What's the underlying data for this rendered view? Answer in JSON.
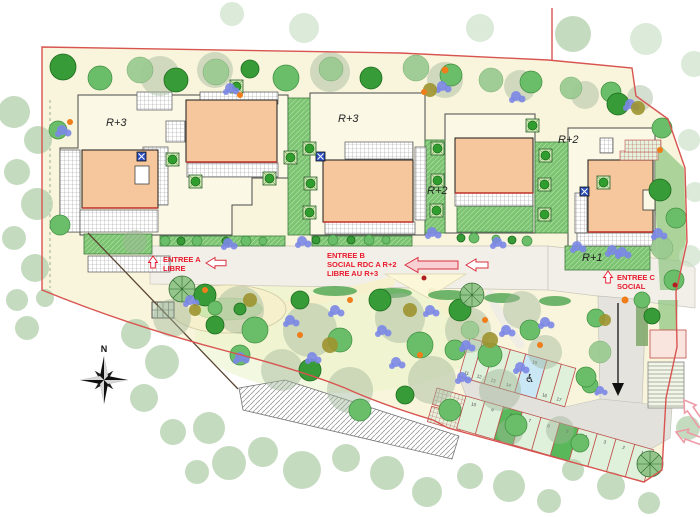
{
  "floor_labels": [
    "R+3",
    "R+3",
    "R+2",
    "R+2",
    "R+1"
  ],
  "entrances": {
    "a1": "ENTREE A",
    "a2": "LIBRE",
    "b1": "ENTREE B",
    "b2": "SOCIAL RDC A R+2",
    "b3": "LIBRE AU R+3",
    "c1": "ENTREE C",
    "c2": "SOCIAL"
  },
  "compass": {
    "north": "N"
  },
  "parking": {
    "upper": [
      "11",
      "12",
      "13",
      "14",
      "15",
      "16",
      "17"
    ],
    "lower": [
      "10",
      "9",
      "8",
      "7",
      "6",
      "5",
      "4",
      "3",
      "2",
      "1"
    ],
    "handicap": "♿"
  },
  "colors": {
    "boundary": "#D85450",
    "building": "#F6C79C",
    "entry_text": "#E8192C",
    "site": "#F8F5DC",
    "road": "#F2EFE8",
    "parking_stall": "#DFF0DB",
    "handicap": "#C9E7F4",
    "lawn": "#7CC472",
    "tree_dark": "#379B37"
  }
}
